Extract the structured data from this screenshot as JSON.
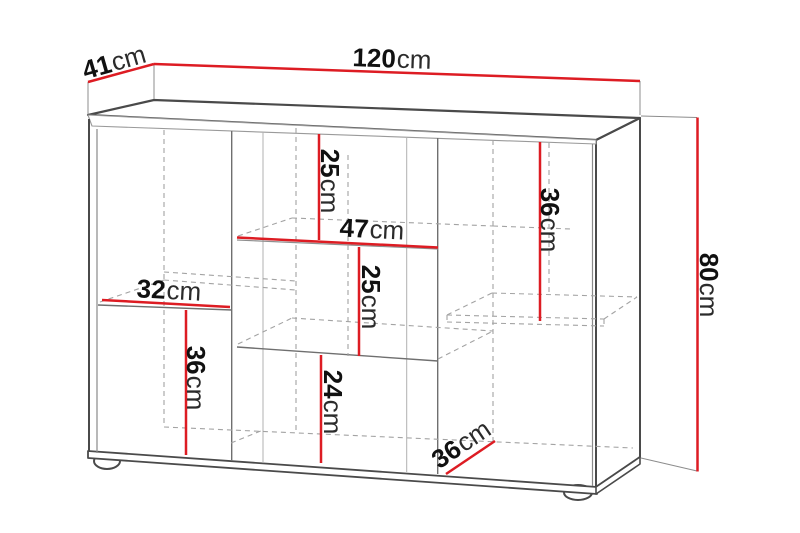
{
  "diagram": {
    "type": "furniture-dimension-drawing",
    "subject": "sideboard cabinet with open shelves, perspective line drawing",
    "units": "cm",
    "overall": {
      "width_cm": 120,
      "depth_cm": 41,
      "height_cm": 80
    },
    "colors": {
      "dimension": "#dd1c23",
      "outline": "#4a4a4a",
      "mid_line": "#6f6f6f",
      "light_line": "#b0b0b0",
      "dashed_line": "#a3a3a3",
      "extension_line": "#8c8c8c",
      "label_number": "#111111",
      "label_unit": "#2b2b2b"
    }
  },
  "dimensions": {
    "depth_top": {
      "num": "41",
      "unit": "cm"
    },
    "width": {
      "num": "120",
      "unit": "cm"
    },
    "height": {
      "num": "80",
      "unit": "cm"
    },
    "mid_top_height": {
      "num": "25",
      "unit": "cm"
    },
    "mid_width": {
      "num": "47",
      "unit": "cm"
    },
    "mid_middle_height": {
      "num": "25",
      "unit": "cm"
    },
    "left_width": {
      "num": "32",
      "unit": "cm"
    },
    "left_bottom_height": {
      "num": "36",
      "unit": "cm"
    },
    "mid_bottom_height": {
      "num": "24",
      "unit": "cm"
    },
    "right_top_height": {
      "num": "36",
      "unit": "cm"
    },
    "inner_depth": {
      "num": "36",
      "unit": "cm"
    }
  }
}
